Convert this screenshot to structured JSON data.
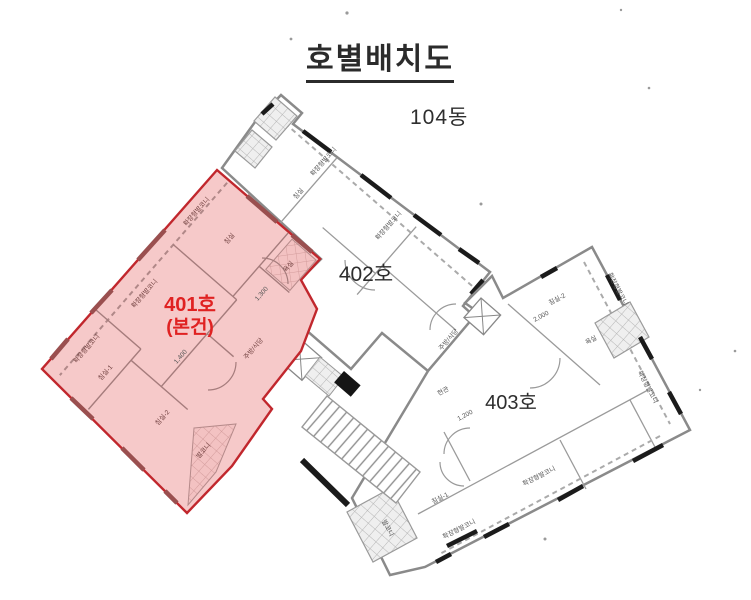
{
  "title": "호별배치도",
  "building_label": "104동",
  "units": {
    "u401": {
      "label": "401호",
      "sublabel": "(본건)",
      "highlighted": true
    },
    "u402": {
      "label": "402호"
    },
    "u403": {
      "label": "403호"
    }
  },
  "rooms": {
    "bedroom": "침실",
    "bedroom1": "침실-1",
    "bedroom2": "침실-2",
    "kitchen_dining": "주방/식당",
    "entrance": "현관",
    "bathroom": "욕실",
    "balcony": "발코니",
    "extended_balcony": "확장형발코니"
  },
  "dimensions": {
    "d1400": "1,400",
    "d1300": "1,300",
    "d2000": "2,000",
    "d1200": "1,200"
  },
  "colors": {
    "highlight_fill": "#f6c9c9",
    "highlight_stroke": "#c1272d",
    "accent_text": "#e02222",
    "wall_gray": "#8a8a8a",
    "wall_black": "#1b1b1b"
  }
}
